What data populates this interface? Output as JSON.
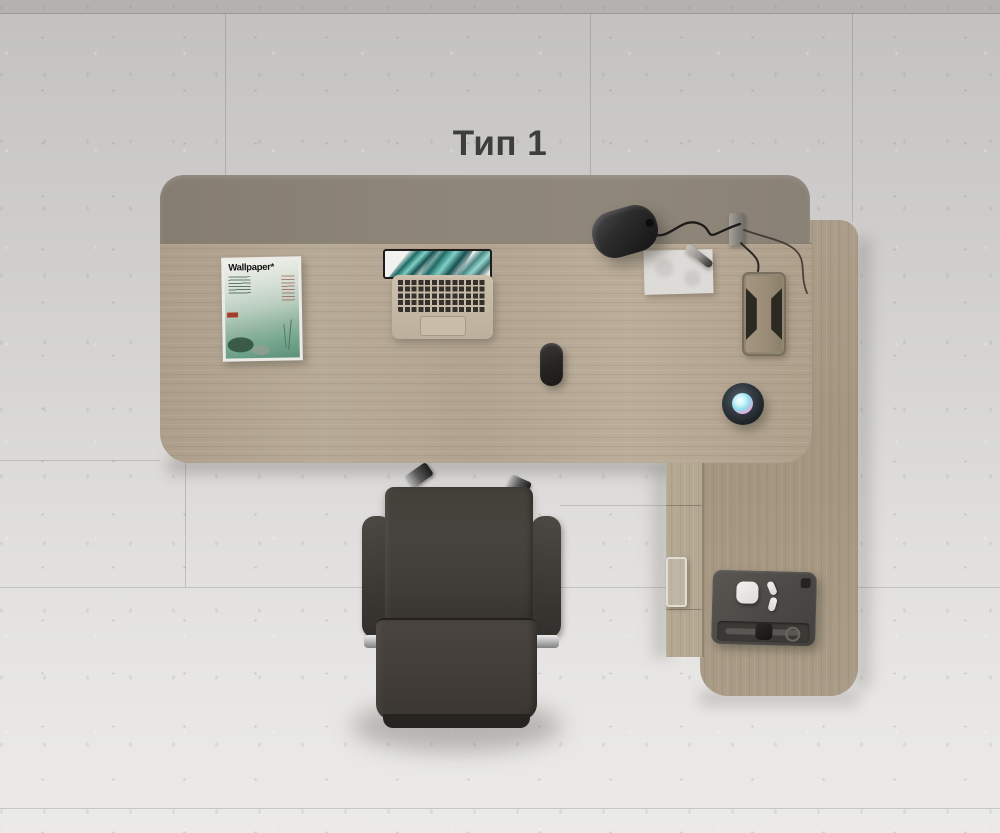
{
  "title": {
    "text": "Тип 1"
  },
  "scene": {
    "description_labels": {
      "magazine_masthead": "Wallpaper*"
    },
    "colors": {
      "floor_top": "#c2c1bf",
      "floor_bottom": "#ebeae8",
      "back_panel": "#8d8478",
      "main_desktop_wood": "#b2a490",
      "return_desktop_wood": "#a89a86",
      "cabinet_wood": "#b5a892",
      "chair_leather": "#403c37",
      "lamp_black": "#1d1c1b",
      "laptop_body": "#c7bba7",
      "speaker_body": "#1e2328",
      "speaker_glow_cyan": "#8fdcee",
      "speaker_glow_pink": "#e7a8d5",
      "tablet_gray": "#4b4845",
      "title_text": "#3e3e3d"
    },
    "objects": [
      "desk-back-panel",
      "main-desktop",
      "return-desktop",
      "cabinet-side",
      "wallpaper-magazine",
      "laptop",
      "mouse",
      "desk-lamp",
      "lamp-mount",
      "cable-grommet",
      "notepad-paper",
      "pen",
      "smart-speaker",
      "tablet",
      "airpods-case",
      "earbuds",
      "smart-watch",
      "office-chair"
    ]
  }
}
